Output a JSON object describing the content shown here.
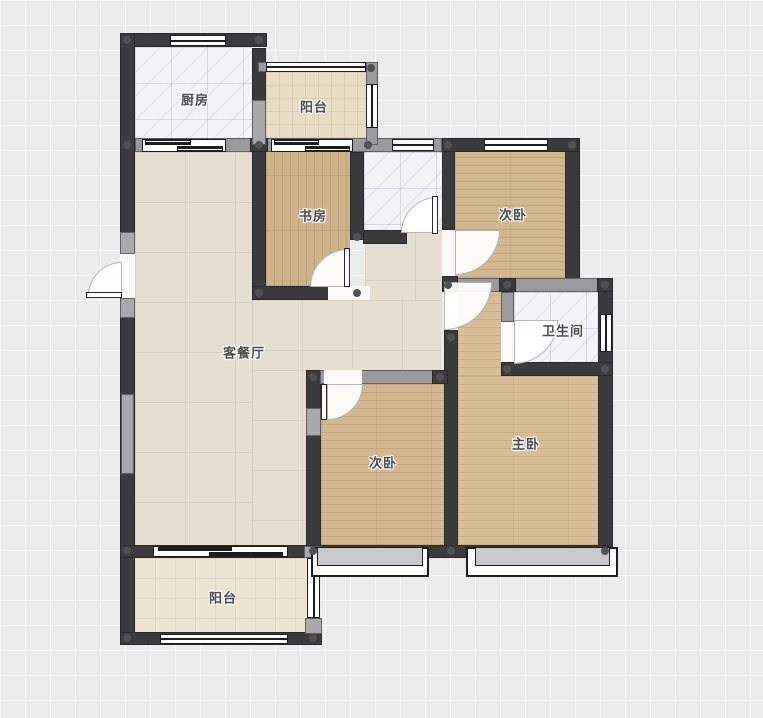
{
  "palette": {
    "bg": "#ececec",
    "grid": "#f8f8f8",
    "wall-dark": "#3b3b3d",
    "wall-gray": "#9b9b9d",
    "label": "#4b4b4e",
    "floor-wood": "#d3b78f",
    "floor-tile-living": "#e5dfd1",
    "floor-tile-balcony-top": "#e8dcc3",
    "floor-tile-balcony-bottom": "#ece5d3",
    "floor-marble": "#f4f4f6"
  },
  "rooms": [
    {
      "id": "kitchen",
      "label": "厨房"
    },
    {
      "id": "balcony-top",
      "label": "阳台"
    },
    {
      "id": "study",
      "label": "书房"
    },
    {
      "id": "bedroom-top",
      "label": "次卧"
    },
    {
      "id": "bathroom",
      "label": "卫生间"
    },
    {
      "id": "living-dining",
      "label": "客餐厅"
    },
    {
      "id": "bedroom-bottom",
      "label": "次卧"
    },
    {
      "id": "master-bedroom",
      "label": "主卧"
    },
    {
      "id": "balcony-bottom",
      "label": "阳台"
    }
  ]
}
